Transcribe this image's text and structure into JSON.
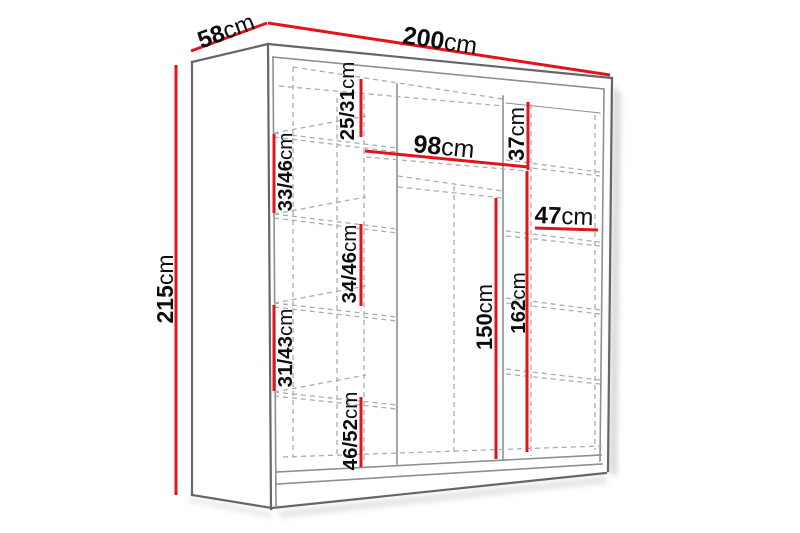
{
  "diagram": {
    "name": "wardrobe-dimensions-diagram",
    "type": "furniture dimension drawing"
  },
  "colors": {
    "dimension_red": "#e2131b",
    "edge_dark": "#63676b",
    "line_gray": "#8b9094",
    "dash_gray": "#a9aeb2",
    "text_black": "#0d0d0d",
    "background": "#ffffff",
    "shadow_gray": "#c4c4c4"
  },
  "dimensions": {
    "width_top": {
      "value": "200",
      "unit": "cm"
    },
    "depth_top": {
      "value": "58",
      "unit": "cm"
    },
    "height_left": {
      "value": "215",
      "unit": "cm"
    },
    "left_top_gap": {
      "value": "25/31",
      "unit": "cm"
    },
    "left_shelf_gap_upper": {
      "value": "33/46",
      "unit": "cm"
    },
    "top_shelf_width": {
      "value": "98",
      "unit": "cm"
    },
    "right_top_gap": {
      "value": "37",
      "unit": "cm"
    },
    "right_shelf_width": {
      "value": "47",
      "unit": "cm"
    },
    "left_shelf_gap_middle": {
      "value": "34/46",
      "unit": "cm"
    },
    "left_shelf_gap_lower": {
      "value": "31/43",
      "unit": "cm"
    },
    "left_shelf_gap_bottom": {
      "value": "46/52",
      "unit": "cm"
    },
    "hanging_height": {
      "value": "150",
      "unit": "cm"
    },
    "interior_height_right": {
      "value": "162",
      "unit": "cm"
    }
  }
}
